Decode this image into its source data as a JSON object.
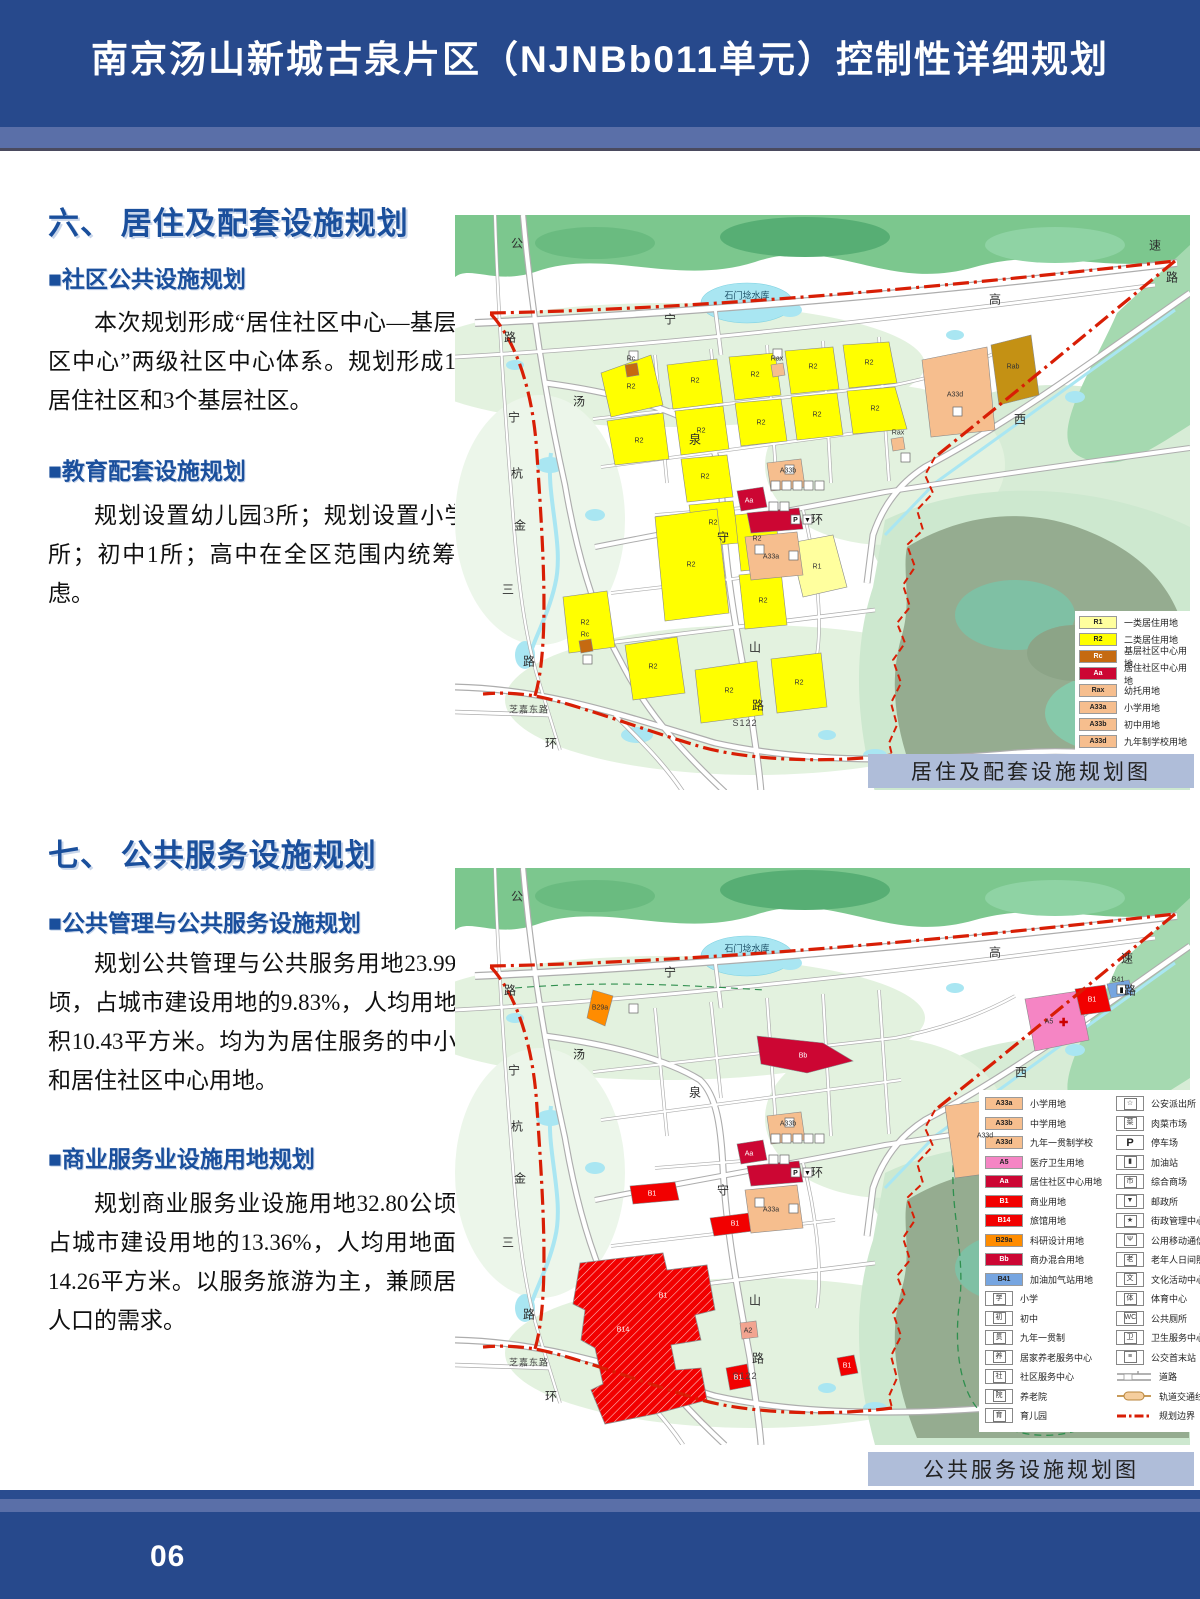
{
  "page": {
    "title": "南京汤山新城古泉片区（NJNBb011单元）控制性详细规划",
    "page_number": "06"
  },
  "section6": {
    "heading": "六、 居住及配套设施规划",
    "sub1_title": "■社区公共设施规划",
    "sub1_body": "本次规划形成“居住社区中心—基层社区中心”两级社区中心体系。规划形成1个居住社区和3个基层社区。",
    "sub2_title": "■教育配套设施规划",
    "sub2_body": "规划设置幼儿园3所；规划设置小学1所；初中1所；高中在全区范围内统筹考虑。",
    "map_caption": "居住及配套设施规划图"
  },
  "section7": {
    "heading": "七、 公共服务设施规划",
    "sub1_title": "■公共管理与公共服务设施规划",
    "sub1_body": "规划公共管理与公共服务用地23.99公顷，占城市建设用地的9.83%，人均用地面积10.43平方米。均为为居住服务的中小学和居住社区中心用地。",
    "sub2_title": "■商业服务业设施用地规划",
    "sub2_body": "规划商业服务业设施用地32.80公顷，占城市建设用地的13.36%，人均用地面积14.26平方米。以服务旅游为主，兼顾居住人口的需求。",
    "map_caption": "公共服务设施规划图"
  },
  "colors": {
    "header_blue": "#27498C",
    "band_blue": "#5A6FA8",
    "heading_blue": "#1A4F9C",
    "caption_bg": "#AFBDD9",
    "boundary_red": "#D81E05",
    "R1": "#FFFF9E",
    "R2": "#FFFF00",
    "RC": "#C56A11",
    "AA": "#CC0633",
    "PEACH": "#F6BE8E",
    "OLIVE": "#C49114",
    "PINK": "#F585C4",
    "RED": "#F20000",
    "ORANGE": "#FF8C00",
    "BLUE": "#76A5E0",
    "SALMON": "#F2A490"
  },
  "legend1": {
    "items": [
      {
        "code": "R1",
        "fill": "R1",
        "light": false,
        "label": "一类居住用地"
      },
      {
        "code": "R2",
        "fill": "R2",
        "light": false,
        "label": "二类居住用地"
      },
      {
        "code": "Rc",
        "fill": "RC",
        "light": true,
        "label": "基层社区中心用地"
      },
      {
        "code": "Aa",
        "fill": "AA",
        "light": true,
        "label": "居住社区中心用地"
      },
      {
        "code": "Rax",
        "fill": "PEACH",
        "light": false,
        "label": "幼托用地"
      },
      {
        "code": "A33a",
        "fill": "PEACH",
        "light": false,
        "label": "小学用地"
      },
      {
        "code": "A33b",
        "fill": "PEACH",
        "light": false,
        "label": "初中用地"
      },
      {
        "code": "A33d",
        "fill": "PEACH",
        "light": false,
        "label": "九年制学校用地"
      }
    ]
  },
  "legend2": {
    "color_items": [
      {
        "code": "A33a",
        "fill": "PEACH",
        "light": false,
        "label": "小学用地"
      },
      {
        "code": "A33b",
        "fill": "PEACH",
        "light": false,
        "label": "中学用地"
      },
      {
        "code": "A33d",
        "fill": "PEACH",
        "light": false,
        "label": "九年一贯制学校"
      },
      {
        "code": "A5",
        "fill": "PINK",
        "light": false,
        "label": "医疗卫生用地"
      },
      {
        "code": "Aa",
        "fill": "AA",
        "light": true,
        "label": "居住社区中心用地"
      },
      {
        "code": "B1",
        "fill": "RED",
        "light": true,
        "label": "商业用地"
      },
      {
        "code": "B14",
        "fill": "RED",
        "light": true,
        "label": "旅馆用地"
      },
      {
        "code": "B29a",
        "fill": "ORANGE",
        "light": false,
        "label": "科研设计用地"
      },
      {
        "code": "Bb",
        "fill": "AA",
        "light": true,
        "label": "商办混合用地"
      },
      {
        "code": "B41",
        "fill": "BLUE",
        "light": false,
        "label": "加油加气站用地"
      }
    ],
    "icon_items_left": [
      {
        "glyph": "学",
        "label": "小学"
      },
      {
        "glyph": "初",
        "label": "初中"
      },
      {
        "glyph": "贯",
        "label": "九年一贯制"
      },
      {
        "glyph": "养",
        "label": "居家养老服务中心"
      },
      {
        "glyph": "社",
        "label": "社区服务中心"
      },
      {
        "glyph": "院",
        "label": "养老院"
      },
      {
        "glyph": "育",
        "label": "育儿园"
      }
    ],
    "icon_items_right": [
      {
        "glyph": "☆",
        "label": "公安派出所"
      },
      {
        "glyph": "菜",
        "label": "肉菜市场"
      },
      {
        "glyph": "P",
        "label": "停车场",
        "big": true
      },
      {
        "glyph": "▮",
        "label": "加油站"
      },
      {
        "glyph": "市",
        "label": "综合商场"
      },
      {
        "glyph": "▼",
        "label": "邮政所"
      },
      {
        "glyph": "★",
        "label": "街政管理中心"
      },
      {
        "glyph": "Ψ",
        "label": "公用移动通信基站"
      },
      {
        "glyph": "老",
        "label": "老年人日间照料中心"
      },
      {
        "glyph": "文",
        "label": "文化活动中心"
      },
      {
        "glyph": "体",
        "label": "体育中心"
      },
      {
        "glyph": "WC",
        "label": "公共厕所"
      },
      {
        "glyph": "卫",
        "label": "卫生服务中心"
      },
      {
        "glyph": "≡",
        "label": "公交首末站"
      }
    ],
    "line_items": [
      {
        "sym": "road",
        "label": "道路"
      },
      {
        "sym": "rail",
        "label": "轨道交通线路及站点"
      },
      {
        "sym": "boundary",
        "label": "规划边界"
      }
    ]
  },
  "map1": {
    "labels": [
      {
        "t": "公",
        "x": 62,
        "y": 28,
        "c": "road"
      },
      {
        "t": "路",
        "x": 55,
        "y": 122,
        "c": "road"
      },
      {
        "t": "宁",
        "x": 59,
        "y": 202,
        "c": "road"
      },
      {
        "t": "杭",
        "x": 62,
        "y": 258,
        "c": "road"
      },
      {
        "t": "金",
        "x": 65,
        "y": 310,
        "c": "road"
      },
      {
        "t": "三",
        "x": 53,
        "y": 374,
        "c": "road"
      },
      {
        "t": "路",
        "x": 74,
        "y": 446,
        "c": "road"
      },
      {
        "t": "芝嘉东路",
        "x": 74,
        "y": 494,
        "c": "roadsm"
      },
      {
        "t": "环",
        "x": 96,
        "y": 528,
        "c": "road"
      },
      {
        "t": "汤",
        "x": 124,
        "y": 186,
        "c": "road"
      },
      {
        "t": "泉",
        "x": 240,
        "y": 224,
        "c": "road"
      },
      {
        "t": "守",
        "x": 268,
        "y": 322,
        "c": "road"
      },
      {
        "t": "山",
        "x": 300,
        "y": 432,
        "c": "road"
      },
      {
        "t": "路",
        "x": 303,
        "y": 490,
        "c": "road"
      },
      {
        "t": "环",
        "x": 362,
        "y": 304,
        "c": "road"
      },
      {
        "t": "宁",
        "x": 215,
        "y": 104,
        "c": "road"
      },
      {
        "t": "高",
        "x": 540,
        "y": 84,
        "c": "road"
      },
      {
        "t": "速",
        "x": 700,
        "y": 30,
        "c": "road"
      },
      {
        "t": "路",
        "x": 717,
        "y": 62,
        "c": "road"
      },
      {
        "t": "西",
        "x": 565,
        "y": 204,
        "c": "road"
      },
      {
        "t": "S122",
        "x": 290,
        "y": 508,
        "c": "roadsm"
      },
      {
        "t": "石门埝水库",
        "x": 292,
        "y": 80,
        "c": "water"
      },
      {
        "t": "R2",
        "x": 176,
        "y": 172,
        "c": "code"
      },
      {
        "t": "R2",
        "x": 240,
        "y": 166,
        "c": "code"
      },
      {
        "t": "R2",
        "x": 300,
        "y": 160,
        "c": "code"
      },
      {
        "t": "R2",
        "x": 358,
        "y": 152,
        "c": "code"
      },
      {
        "t": "R2",
        "x": 414,
        "y": 148,
        "c": "code"
      },
      {
        "t": "R2",
        "x": 184,
        "y": 226,
        "c": "code"
      },
      {
        "t": "R2",
        "x": 246,
        "y": 216,
        "c": "code"
      },
      {
        "t": "R2",
        "x": 306,
        "y": 208,
        "c": "code"
      },
      {
        "t": "R2",
        "x": 362,
        "y": 200,
        "c": "code"
      },
      {
        "t": "R2",
        "x": 420,
        "y": 194,
        "c": "code"
      },
      {
        "t": "R2",
        "x": 250,
        "y": 262,
        "c": "code"
      },
      {
        "t": "R2",
        "x": 258,
        "y": 308,
        "c": "code"
      },
      {
        "t": "R2",
        "x": 236,
        "y": 350,
        "c": "code"
      },
      {
        "t": "R2",
        "x": 302,
        "y": 324,
        "c": "code"
      },
      {
        "t": "R2",
        "x": 308,
        "y": 386,
        "c": "code"
      },
      {
        "t": "R2",
        "x": 130,
        "y": 408,
        "c": "code"
      },
      {
        "t": "R2",
        "x": 198,
        "y": 452,
        "c": "code"
      },
      {
        "t": "R2",
        "x": 274,
        "y": 476,
        "c": "code"
      },
      {
        "t": "R2",
        "x": 344,
        "y": 468,
        "c": "code"
      },
      {
        "t": "R1",
        "x": 362,
        "y": 352,
        "c": "code"
      },
      {
        "t": "A33d",
        "x": 500,
        "y": 180,
        "c": "code"
      },
      {
        "t": "Rab",
        "x": 558,
        "y": 152,
        "c": "code"
      },
      {
        "t": "Rax",
        "x": 443,
        "y": 218,
        "c": "code"
      },
      {
        "t": "Rax",
        "x": 322,
        "y": 144,
        "c": "code"
      },
      {
        "t": "Rc",
        "x": 176,
        "y": 144,
        "c": "code"
      },
      {
        "t": "Rc",
        "x": 130,
        "y": 420,
        "c": "code"
      },
      {
        "t": "Aa",
        "x": 294,
        "y": 286,
        "c": "codew"
      },
      {
        "t": "A33b",
        "x": 333,
        "y": 256,
        "c": "code"
      },
      {
        "t": "A33a",
        "x": 316,
        "y": 342,
        "c": "code"
      }
    ]
  },
  "map2": {
    "labels": [
      {
        "t": "公",
        "x": 62,
        "y": 28,
        "c": "road"
      },
      {
        "t": "路",
        "x": 55,
        "y": 122,
        "c": "road"
      },
      {
        "t": "宁",
        "x": 59,
        "y": 202,
        "c": "road"
      },
      {
        "t": "杭",
        "x": 62,
        "y": 258,
        "c": "road"
      },
      {
        "t": "金",
        "x": 65,
        "y": 310,
        "c": "road"
      },
      {
        "t": "三",
        "x": 53,
        "y": 374,
        "c": "road"
      },
      {
        "t": "路",
        "x": 74,
        "y": 446,
        "c": "road"
      },
      {
        "t": "芝嘉东路",
        "x": 74,
        "y": 494,
        "c": "roadsm"
      },
      {
        "t": "环",
        "x": 96,
        "y": 528,
        "c": "road"
      },
      {
        "t": "汤",
        "x": 124,
        "y": 186,
        "c": "road"
      },
      {
        "t": "泉",
        "x": 240,
        "y": 224,
        "c": "road"
      },
      {
        "t": "守",
        "x": 268,
        "y": 322,
        "c": "road"
      },
      {
        "t": "山",
        "x": 300,
        "y": 432,
        "c": "road"
      },
      {
        "t": "路",
        "x": 303,
        "y": 490,
        "c": "road"
      },
      {
        "t": "环",
        "x": 362,
        "y": 304,
        "c": "road"
      },
      {
        "t": "宁",
        "x": 215,
        "y": 104,
        "c": "road"
      },
      {
        "t": "高",
        "x": 540,
        "y": 84,
        "c": "road"
      },
      {
        "t": "速",
        "x": 672,
        "y": 90,
        "c": "road"
      },
      {
        "t": "路",
        "x": 675,
        "y": 122,
        "c": "road"
      },
      {
        "t": "西",
        "x": 566,
        "y": 204,
        "c": "road"
      },
      {
        "t": "S122",
        "x": 290,
        "y": 508,
        "c": "roadsm"
      },
      {
        "t": "石门埝水库",
        "x": 292,
        "y": 80,
        "c": "water"
      },
      {
        "t": "B29a",
        "x": 145,
        "y": 140,
        "c": "code"
      },
      {
        "t": "Bb",
        "x": 348,
        "y": 188,
        "c": "codew"
      },
      {
        "t": "A5",
        "x": 594,
        "y": 154,
        "c": "code"
      },
      {
        "t": "B1",
        "x": 637,
        "y": 132,
        "c": "codew"
      },
      {
        "t": "B41",
        "x": 663,
        "y": 112,
        "c": "code"
      },
      {
        "t": "A33d",
        "x": 530,
        "y": 268,
        "c": "code"
      },
      {
        "t": "B1",
        "x": 197,
        "y": 326,
        "c": "codew"
      },
      {
        "t": "B1",
        "x": 280,
        "y": 356,
        "c": "codew"
      },
      {
        "t": "B14",
        "x": 168,
        "y": 462,
        "c": "codew"
      },
      {
        "t": "B1",
        "x": 208,
        "y": 428,
        "c": "codew"
      },
      {
        "t": "B1",
        "x": 283,
        "y": 510,
        "c": "codew"
      },
      {
        "t": "B1",
        "x": 392,
        "y": 498,
        "c": "codew"
      },
      {
        "t": "A2",
        "x": 293,
        "y": 463,
        "c": "code"
      },
      {
        "t": "Aa",
        "x": 294,
        "y": 286,
        "c": "codew"
      },
      {
        "t": "A33b",
        "x": 333,
        "y": 256,
        "c": "code"
      },
      {
        "t": "A33a",
        "x": 316,
        "y": 342,
        "c": "code"
      }
    ]
  }
}
